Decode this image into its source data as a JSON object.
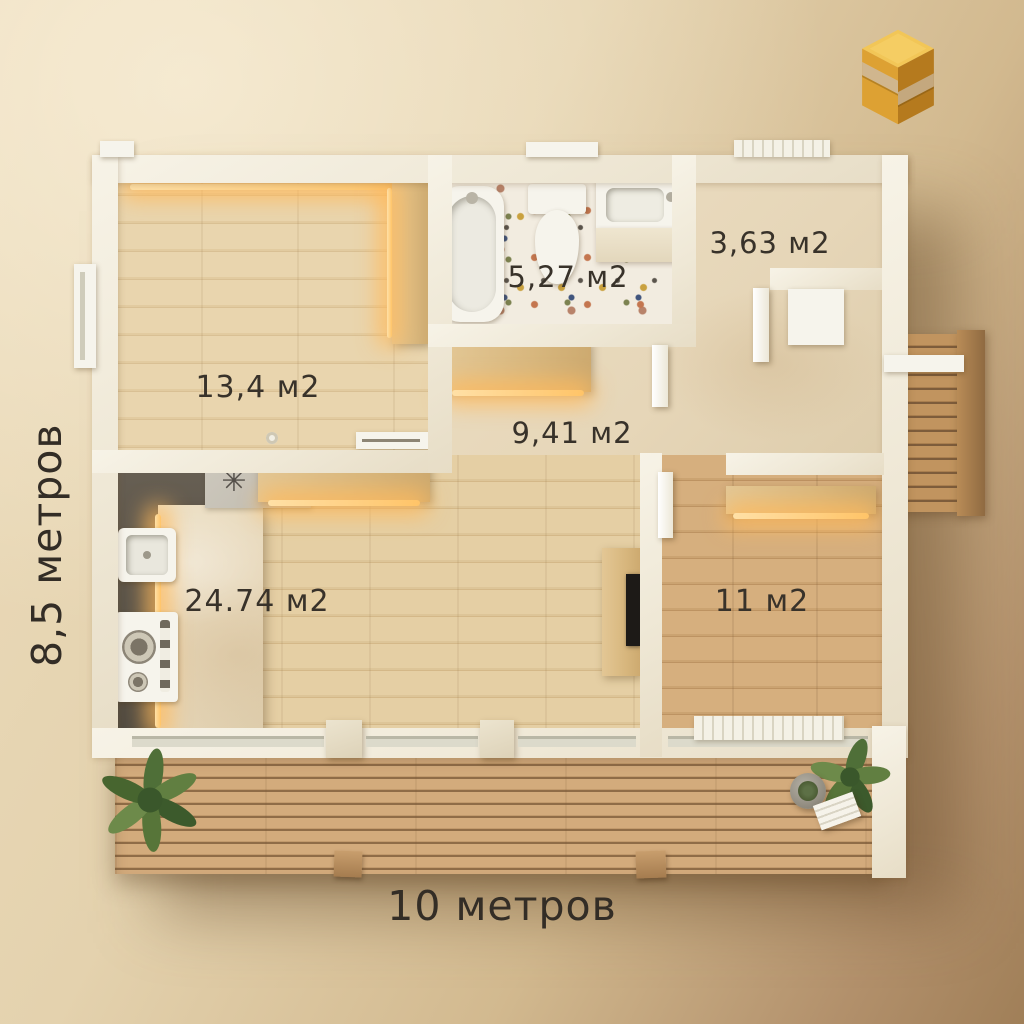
{
  "image": {
    "kind": "3d-floor-plan-top-view-render",
    "style": "warm beige interior render with white walls and wood floors"
  },
  "branding": {
    "logo_name": "gold-3d-s-block-logo"
  },
  "dimensions": {
    "height_label": "8,5 метров",
    "width_label": "10 метров"
  },
  "rooms": [
    {
      "name": "room-top-left",
      "area": "13,4 м2"
    },
    {
      "name": "bathroom",
      "area": "5,27 м2"
    },
    {
      "name": "entry",
      "area": "3,63 м2"
    },
    {
      "name": "hallway",
      "area": "9,41 м2"
    },
    {
      "name": "living-kitchen",
      "area": "24.74 м2"
    },
    {
      "name": "bedroom",
      "area": "11 м2"
    }
  ],
  "symbols": {
    "kitchen_mat_star": "✳"
  },
  "colors": {
    "background_light": "#ecdcbc",
    "background_dark": "#a07f58",
    "wall": "#f3eee0",
    "wood_light": "#e4cfa6",
    "wood_bedroom": "#cfa97a",
    "terrace_wood": "#c9a172",
    "marble": "#e9dcc1",
    "kitchen_floor": "#5f584e",
    "terrazzo_base": "#f2ece0",
    "led_glow": "#ffc879",
    "label_text": "#38322a",
    "logo_gold": "#d89a2e"
  }
}
